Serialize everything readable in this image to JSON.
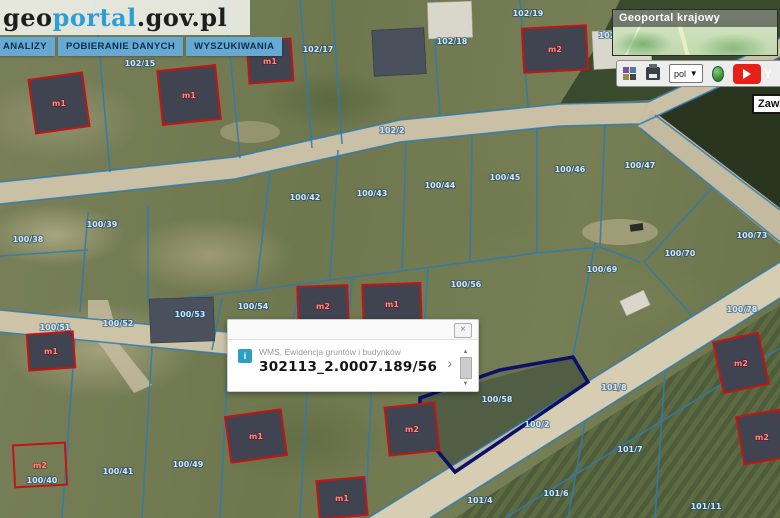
{
  "logo": {
    "geo": "geo",
    "portal": "portal",
    "suffix": ".gov.pl"
  },
  "menu": {
    "items": [
      {
        "label": "ANALIZY"
      },
      {
        "label": "POBIERANIE DANYCH"
      },
      {
        "label": "WYSZUKIWANIA"
      }
    ]
  },
  "overview": {
    "title": "Geoportal krajowy"
  },
  "toolbar": {
    "language_value": "pol",
    "select_chevron": "▼",
    "youtube_text": "Y"
  },
  "map_contents_label": "Zawa",
  "popup": {
    "info_icon": "i",
    "source_label": "WMS, Ewidencja gruntów i budynków",
    "feature_id": "302113_2.0007.189/56",
    "chevron": "›",
    "close": "×",
    "scroll_up": "▲",
    "scroll_down": "▼"
  },
  "map": {
    "colors": {
      "parcel_line": "#2e7ab2",
      "parcel_label": "#cfe9fb",
      "building_outline": "#c41414",
      "building_label": "#ff8a8a",
      "selection": "#0c1066"
    },
    "selected_parcel": {
      "points": "420,398 500,370 573,357 588,382 455,472 420,430"
    },
    "parcel_labels": [
      {
        "t": "102/15",
        "x": 140,
        "y": 66
      },
      {
        "t": "102/17",
        "x": 318,
        "y": 52
      },
      {
        "t": "102/18",
        "x": 452,
        "y": 44
      },
      {
        "t": "102/19",
        "x": 528,
        "y": 16
      },
      {
        "t": "102/20",
        "x": 614,
        "y": 38
      },
      {
        "t": "102/2",
        "x": 392,
        "y": 133
      },
      {
        "t": "100/38",
        "x": 28,
        "y": 242
      },
      {
        "t": "100/39",
        "x": 102,
        "y": 227
      },
      {
        "t": "100/42",
        "x": 305,
        "y": 200
      },
      {
        "t": "100/43",
        "x": 372,
        "y": 196
      },
      {
        "t": "100/44",
        "x": 440,
        "y": 188
      },
      {
        "t": "100/45",
        "x": 505,
        "y": 180
      },
      {
        "t": "100/46",
        "x": 570,
        "y": 172
      },
      {
        "t": "100/47",
        "x": 640,
        "y": 168
      },
      {
        "t": "100/73",
        "x": 752,
        "y": 238
      },
      {
        "t": "100/70",
        "x": 680,
        "y": 256
      },
      {
        "t": "100/69",
        "x": 602,
        "y": 272
      },
      {
        "t": "100/51",
        "x": 55,
        "y": 330
      },
      {
        "t": "100/52",
        "x": 118,
        "y": 326
      },
      {
        "t": "100/53",
        "x": 190,
        "y": 317
      },
      {
        "t": "100/54",
        "x": 253,
        "y": 309
      },
      {
        "t": "100/56",
        "x": 466,
        "y": 287
      },
      {
        "t": "100/58",
        "x": 497,
        "y": 402
      },
      {
        "t": "100/2",
        "x": 537,
        "y": 427
      },
      {
        "t": "100/78",
        "x": 742,
        "y": 312
      },
      {
        "t": "101/8",
        "x": 614,
        "y": 390
      },
      {
        "t": "100/40",
        "x": 42,
        "y": 483
      },
      {
        "t": "100/41",
        "x": 118,
        "y": 474
      },
      {
        "t": "100/49",
        "x": 188,
        "y": 467
      },
      {
        "t": "101/4",
        "x": 480,
        "y": 503
      },
      {
        "t": "101/6",
        "x": 556,
        "y": 496
      },
      {
        "t": "101/7",
        "x": 630,
        "y": 452
      },
      {
        "t": "101/11",
        "x": 706,
        "y": 509
      }
    ],
    "buildings": [
      {
        "x": 32,
        "y": 76,
        "w": 54,
        "h": 54,
        "r": -8,
        "label": "m1",
        "kind": "red"
      },
      {
        "x": 160,
        "y": 68,
        "w": 58,
        "h": 54,
        "r": -6,
        "label": "m1",
        "kind": "red"
      },
      {
        "x": 248,
        "y": 40,
        "w": 44,
        "h": 42,
        "r": -4,
        "label": "m1",
        "kind": "red"
      },
      {
        "x": 523,
        "y": 27,
        "w": 64,
        "h": 44,
        "r": -3,
        "label": "m2",
        "kind": "red"
      },
      {
        "x": 298,
        "y": 286,
        "w": 50,
        "h": 40,
        "r": -2,
        "label": "m2",
        "kind": "red"
      },
      {
        "x": 363,
        "y": 284,
        "w": 58,
        "h": 40,
        "r": -2,
        "label": "m1",
        "kind": "red"
      },
      {
        "x": 28,
        "y": 333,
        "w": 46,
        "h": 36,
        "r": -4,
        "label": "m1",
        "kind": "red"
      },
      {
        "x": 14,
        "y": 444,
        "w": 52,
        "h": 42,
        "r": -3,
        "label": "m2",
        "kind": "red-empty"
      },
      {
        "x": 228,
        "y": 413,
        "w": 56,
        "h": 46,
        "r": -8,
        "label": "m1",
        "kind": "red"
      },
      {
        "x": 387,
        "y": 405,
        "w": 50,
        "h": 48,
        "r": -6,
        "label": "m2",
        "kind": "red"
      },
      {
        "x": 318,
        "y": 479,
        "w": 48,
        "h": 38,
        "r": -5,
        "label": "m1",
        "kind": "red"
      },
      {
        "x": 718,
        "y": 337,
        "w": 46,
        "h": 52,
        "r": -12,
        "label": "m2",
        "kind": "red"
      },
      {
        "x": 740,
        "y": 413,
        "w": 44,
        "h": 48,
        "r": -10,
        "label": "m2",
        "kind": "red"
      },
      {
        "x": 373,
        "y": 29,
        "w": 52,
        "h": 46,
        "r": -3,
        "kind": "roof"
      },
      {
        "x": 150,
        "y": 298,
        "w": 64,
        "h": 44,
        "r": -2,
        "kind": "roof"
      },
      {
        "x": 593,
        "y": 30,
        "w": 58,
        "h": 38,
        "r": -3,
        "kind": "roof-light"
      },
      {
        "x": 428,
        "y": 2,
        "w": 44,
        "h": 36,
        "r": -2,
        "kind": "roof-light"
      },
      {
        "x": 622,
        "y": 295,
        "w": 26,
        "h": 16,
        "r": -25,
        "kind": "roof-light"
      }
    ]
  }
}
